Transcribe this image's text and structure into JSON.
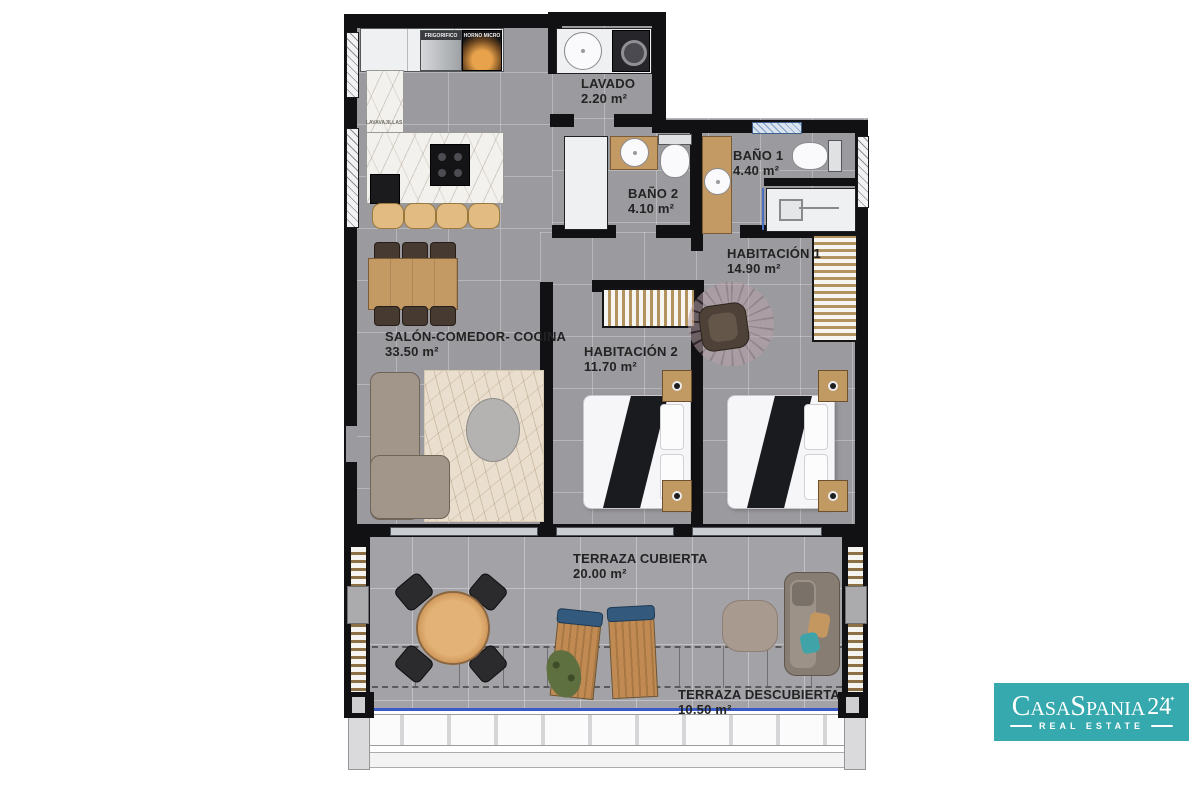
{
  "rooms": {
    "lavado": {
      "name": "LAVADO",
      "area": "2.20 m²"
    },
    "bano2": {
      "name": "BAÑO 2",
      "area": "4.10 m²"
    },
    "bano1": {
      "name": "BAÑO 1",
      "area": "4.40 m²"
    },
    "habitacion1": {
      "name": "HABITACIÓN 1",
      "area": "14.90 m²"
    },
    "habitacion2": {
      "name": "HABITACIÓN 2",
      "area": "11.70 m²"
    },
    "salon": {
      "name": "SALÓN-COMEDOR- COCINA",
      "area": "33.50 m²"
    },
    "terraza_cubierta": {
      "name": "TERRAZA CUBIERTA",
      "area": "20.00 m²"
    },
    "terraza_descubierta": {
      "name": "TERRAZA DESCUBIERTA",
      "area": "10.50 m²"
    }
  },
  "appliances": {
    "fridge": "FRIGORIFICO",
    "oven": "HORNO MICRO",
    "dishwasher": "LAVAVAJILLAS"
  },
  "logo": {
    "brand": "CasaSpania",
    "number": "24",
    "sparkles": "✦ ✦",
    "tagline": "REAL ESTATE"
  },
  "colors": {
    "brand_teal": "#35a9ad",
    "wall": "#111114",
    "floor_gray": "#9b9a9e",
    "terrace_gray": "#a3a2a6",
    "wood": "#c49a64",
    "glass_blue": "#4a6fc0"
  }
}
